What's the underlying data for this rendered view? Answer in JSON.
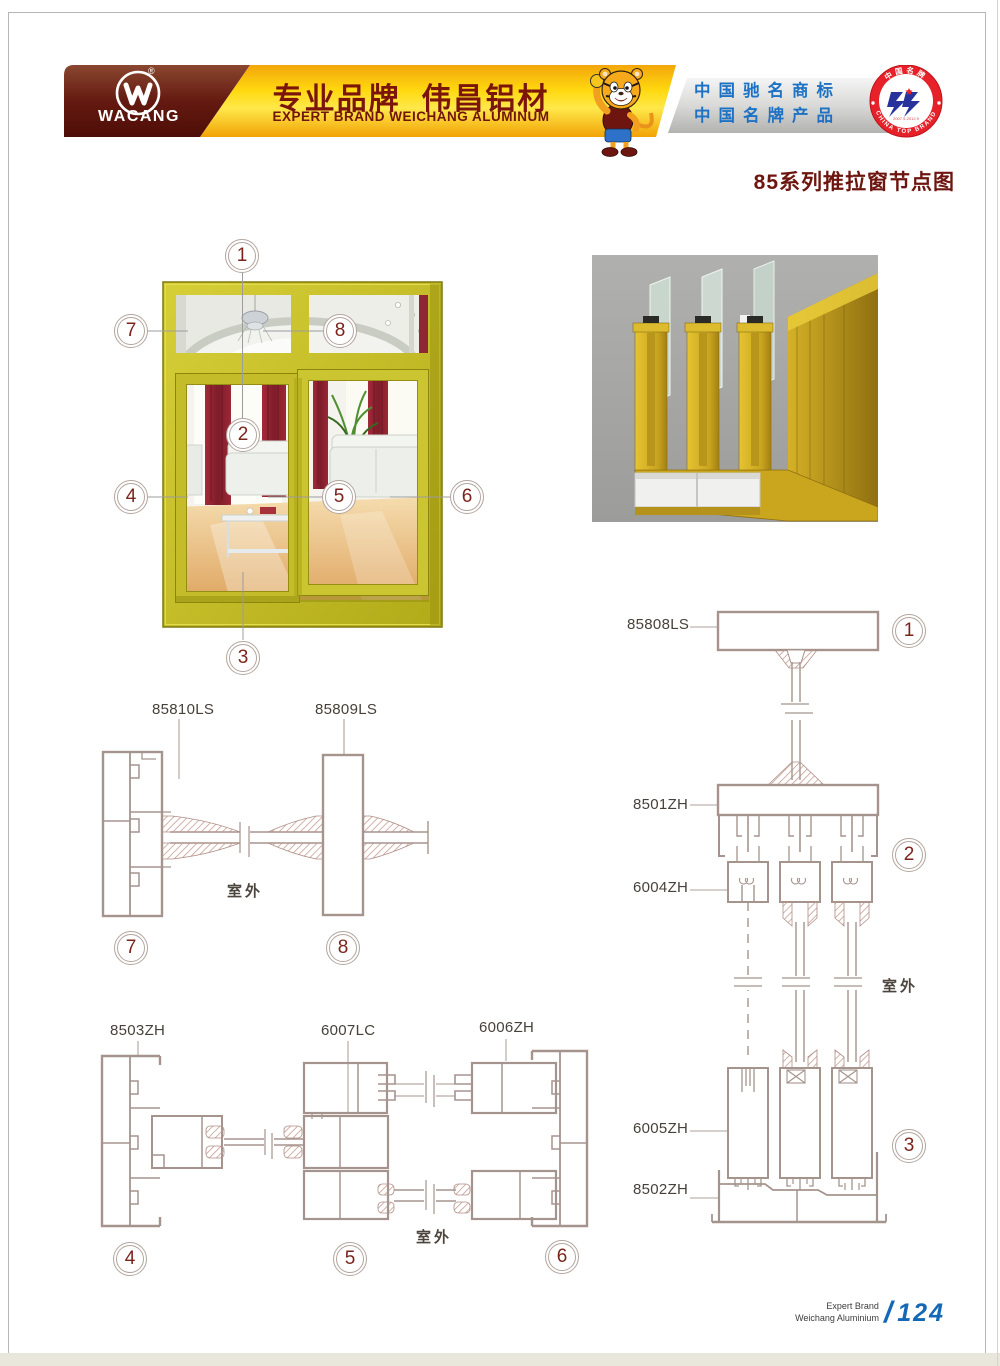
{
  "colors": {
    "banner_yellow": "#ffd40a",
    "brand_maroon": "#5e150d",
    "honor_blue": "#1d72c5",
    "badge_red": "#e62129",
    "footer_blue": "#1468b6",
    "drawing_line": "#a5948d",
    "window_frame_yellow": "#c4bd2b",
    "render_bg": "#a7a7a5"
  },
  "header": {
    "logo": {
      "brand": "WACANG",
      "registered": "®"
    },
    "slogan_cn": "专业品牌  伟昌铝材",
    "slogan_en": "EXPERT BRAND WEICHANG ALUMINUM",
    "honors_line1": "中国驰名商标",
    "honors_line2": "中国名牌产品",
    "badge": {
      "arc_top": "中国名牌",
      "arc_bottom": "CHINA TOP BRAND",
      "dates": "2007.9-2012.9"
    }
  },
  "page_title": "85系列推拉窗节点图",
  "window_figure": {
    "callouts": [
      "1",
      "2",
      "3",
      "4",
      "5",
      "6",
      "7",
      "8"
    ]
  },
  "diagrams": {
    "mid_left": {
      "labels": [
        "85810LS",
        "85809LS"
      ],
      "outdoor": "室外",
      "callouts": [
        "7",
        "8"
      ]
    },
    "bottom_left": {
      "labels": [
        "8503ZH",
        "6007LC",
        "6006ZH"
      ],
      "outdoor": "室外",
      "callouts": [
        "4",
        "5",
        "6"
      ]
    },
    "right": {
      "labels": [
        "85808LS",
        "8501ZH",
        "6004ZH",
        "6005ZH",
        "8502ZH"
      ],
      "outdoor": "室外",
      "callouts": [
        "1",
        "2",
        "3"
      ]
    }
  },
  "footer": {
    "brand_line1": "Expert Brand",
    "brand_line2": "Weichang Aluminium",
    "slash": "/",
    "page_number": "124"
  }
}
